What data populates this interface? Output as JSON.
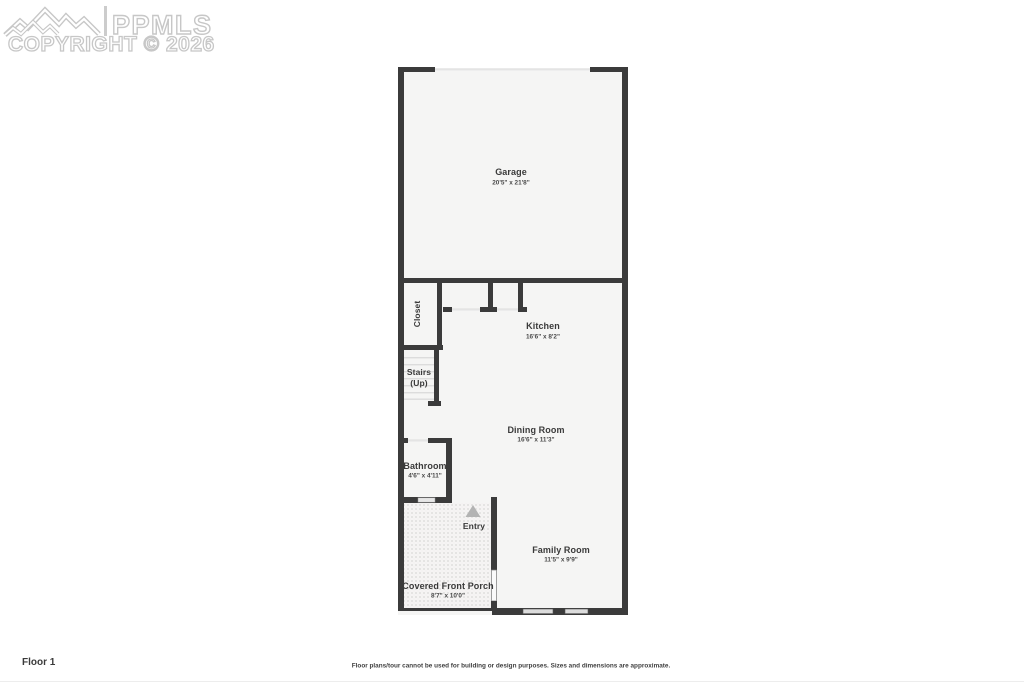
{
  "watermark": {
    "logo_text": "PPMLS",
    "copyright_text": "COPYRIGHT © 2026"
  },
  "plan": {
    "rooms": {
      "garage": {
        "label": "Garage",
        "dims": "20'5\" x 21'8\""
      },
      "closet": {
        "label": "Closet"
      },
      "kitchen": {
        "label": "Kitchen",
        "dims": "16'6\" x 8'2\""
      },
      "stairs": {
        "label_line1": "Stairs",
        "label_line2": "(Up)"
      },
      "dining_room": {
        "label": "Dining Room",
        "dims": "16'6\" x 11'3\""
      },
      "bathroom": {
        "label": "Bathroom",
        "dims": "4'6\" x 4'11\""
      },
      "entry": {
        "label": "Entry"
      },
      "family_room": {
        "label": "Family Room",
        "dims": "11'5\" x 9'9\""
      },
      "covered_front_porch": {
        "label": "Covered Front Porch",
        "dims": "8'7\" x 10'0\""
      }
    }
  },
  "footer": {
    "floor_label": "Floor 1",
    "disclaimer": "Floor plans/tour cannot be used for building or design purposes. Sizes and dimensions are approximate."
  },
  "colors": {
    "wall": "#3b3b3b",
    "room_fill": "#f5f5f4",
    "opening_line": "#e4e4e4",
    "watermark_outline": "#c7c7c7",
    "entry_arrow": "#b3b3b3"
  }
}
